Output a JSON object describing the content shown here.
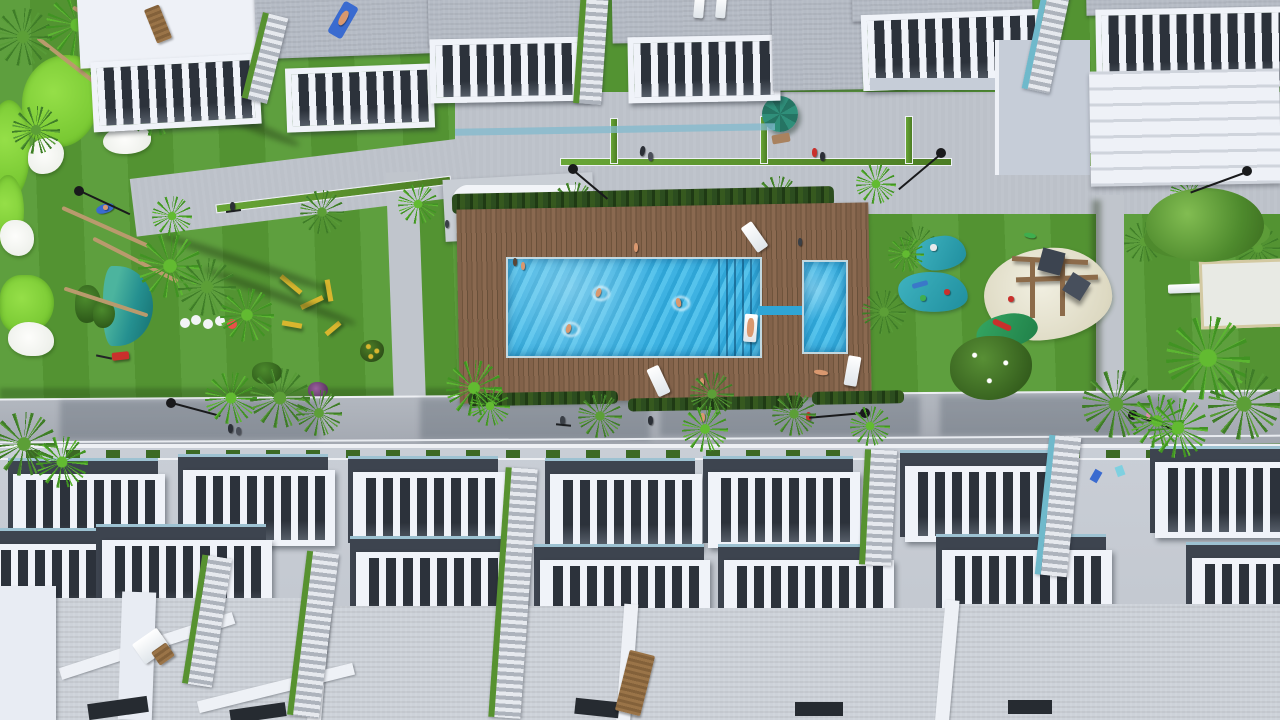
{
  "meta": {
    "title": "Aerial 3D render — residential complex with communal pool garden",
    "canvas": {
      "width": 1280,
      "height": 720
    }
  },
  "palette": {
    "grass": "#579b35",
    "grassLight": "#66ad3f",
    "grassDark": "#47822a",
    "golfGreen": "#86d63a",
    "bunkerWhite": "#f2f4f0",
    "pondTeal": "#2f9f92",
    "deckWood": "#7f5f45",
    "hedge": "#2c4d1f",
    "poolBlue": "#3fb3e2",
    "buildingWhite": "#eef1f7",
    "buildingShade": "#c6cdd8",
    "roofGray": "#b5bbc5",
    "roofLight": "#cdd2d9",
    "terraceDark": "#3d444f",
    "railWhite": "#f0f3f9",
    "street": "#a9aeb6",
    "path": "#c0c5cc",
    "stairGreen": "#5b9630",
    "glassTeal": "#9fcbd8",
    "lamp": "#191a1c",
    "sand": "#e9e6d4",
    "wood": "#8c6b4a",
    "skin": "#d9986f",
    "red": "#c9302c",
    "blue": "#3a6bd0",
    "teal": "#2f8f7a",
    "yellow": "#d8b62e"
  },
  "scene": {
    "type": "aerial 3D architectural render, top-down view",
    "upper_row": {
      "apartment_buildings": 7,
      "features": [
        "gray flat roofs",
        "white slatted terrace balustrades",
        "staircases with green strips",
        "roof sun loungers",
        "sunbather on roof towel"
      ]
    },
    "plaza": {
      "features": [
        "paved promenade",
        "green landscaping strips",
        "small palm trees",
        "street lamps",
        "pedestrians",
        "teal parasol",
        "white benches",
        "white sculptural benches on pad"
      ]
    },
    "pool_area": {
      "wood_deck": true,
      "hedge_border": true,
      "main_pool_with_corner_steps": 1,
      "kids_pool": 1,
      "connector_channel": 1,
      "swimmers": 3,
      "pool_float_with_person": 1,
      "sun_loungers": 3,
      "people_on_deck": 5
    },
    "kids_zone": {
      "splash_pads": 2,
      "sand_playground": 1,
      "wooden_play_structure_with_canopies": 1,
      "green_slide_pad": 1,
      "flowering_bush": 1,
      "bench": 1,
      "boules_pad": 1
    },
    "left_garden": {
      "putting_greens": 4,
      "sand_bunkers": 4,
      "pond": 1,
      "palm_trees": "many, with long shadows",
      "yellow_playground_equipment": 5,
      "white_caterpillar_toy": 1,
      "red_lawn_mower": 1,
      "person_on_blue_towel": 1
    },
    "street": {
      "palm_trees": true,
      "street_lamps": 3,
      "pedestrians": true,
      "cyclist": 1,
      "building_shadows": 4
    },
    "lower_rows": {
      "terraced_houses_row1": 7,
      "terraced_houses_row2": 7,
      "features": [
        "rooftop terraces with white slatted balustrades",
        "green stair strips between houses",
        "large light textured roofs",
        "roof lounger",
        "roof table set",
        "planter strip along street"
      ]
    },
    "counts": {
      "street_lamps_total": 7,
      "palm_crowns_total": 38,
      "people_total": 22,
      "sun_loungers_total": 8
    }
  }
}
